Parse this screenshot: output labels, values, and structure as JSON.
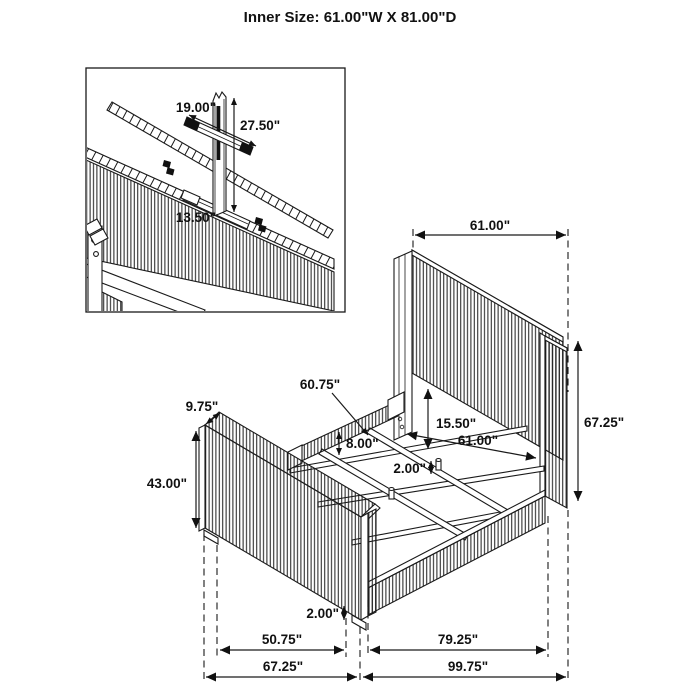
{
  "title": "Inner Size: 61.00\"W X 81.00\"D",
  "inner_size": {
    "width": "61.00\"",
    "depth": "81.00\""
  },
  "colors": {
    "ink": "#1a1a1a",
    "background": "#ffffff"
  },
  "inset_detail": {
    "description": "headboard-back-center-support-detail",
    "dims": {
      "brace_width": "19.00\"",
      "support_height": "27.50\"",
      "cleat_length": "13.50\""
    }
  },
  "bed_diagram": {
    "dims": {
      "headboard_width": "61.00\"",
      "headboard_height": "67.25\"",
      "panel_to_rail_gap": "15.50\"",
      "inner_width": "61.00\"",
      "left_rail_length": "60.75\"",
      "footboard_top_depth": "9.75\"",
      "rail_height": "8.00\"",
      "peg_length": "2.00\"",
      "footboard_height": "43.00\"",
      "foot_clearance": "2.00\"",
      "footboard_inner_span": "50.75\"",
      "side_rail_span": "79.25\"",
      "footboard_overall": "67.25\"",
      "overall_length": "99.75\""
    }
  }
}
